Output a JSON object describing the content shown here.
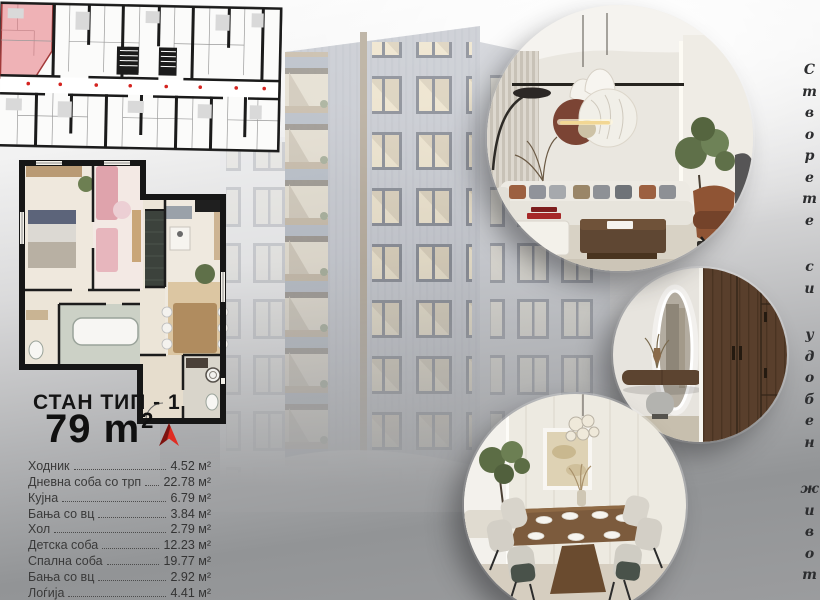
{
  "unit": {
    "title": "СТАН ТИП - 1",
    "area_value": "79 m",
    "area_sup": "2"
  },
  "rooms": [
    {
      "name": "Ходник",
      "area": "4.52 м²"
    },
    {
      "name": "Дневна соба со трп",
      "area": "22.78 м²"
    },
    {
      "name": "Кујна",
      "area": "6.79 м²"
    },
    {
      "name": "Бања со вц",
      "area": "3.84 м²"
    },
    {
      "name": "Хол",
      "area": "2.79 м²"
    },
    {
      "name": "Детска соба",
      "area": "12.23 м²"
    },
    {
      "name": "Спална соба",
      "area": "19.77 м²"
    },
    {
      "name": "Бања со вц",
      "area": "2.92 м²"
    },
    {
      "name": "Лоѓија",
      "area": "4.41 м²"
    }
  ],
  "tagline": {
    "text": "Створете си удобен живот",
    "words": [
      "Створете",
      "си",
      "удобен",
      "живот"
    ]
  },
  "photos": [
    {
      "label": "living-room-interior-render"
    },
    {
      "label": "entry-hall-interior-render"
    },
    {
      "label": "dining-room-interior-render"
    }
  ],
  "plans": {
    "overview_label": "building-floor-plan-with-unit-highlight",
    "unit_label": "apartment-type-1-floor-plan"
  },
  "colors": {
    "accent_red": "#df2b22",
    "highlight_pink": "#efb2b6",
    "text_dark": "#3a3a3a"
  }
}
